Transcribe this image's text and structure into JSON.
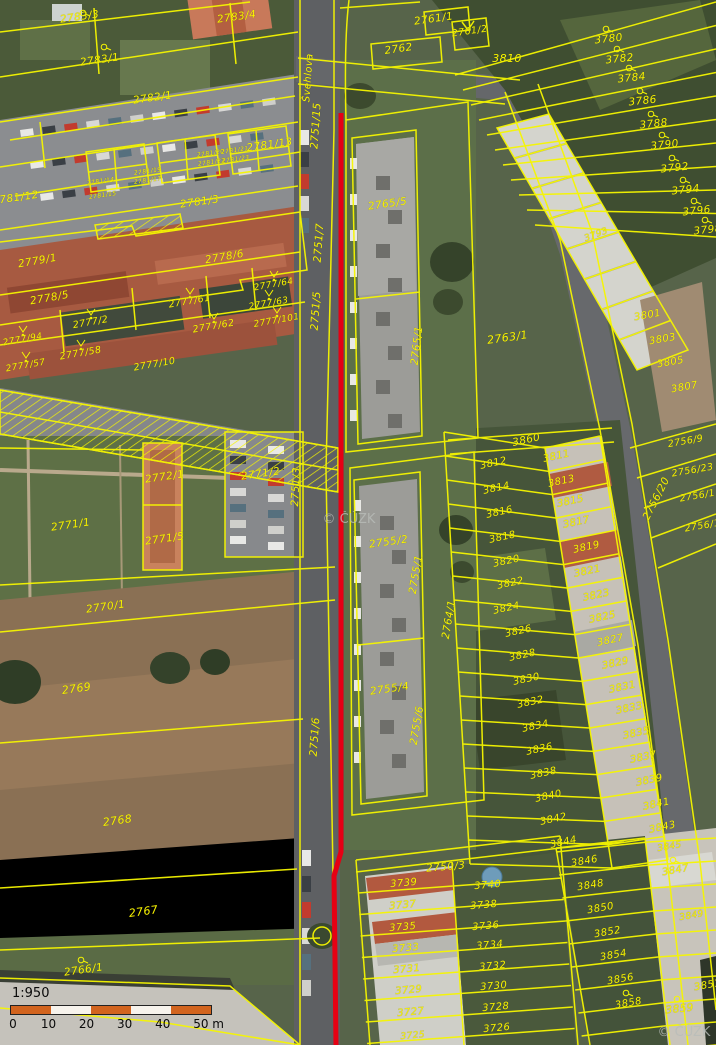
{
  "map": {
    "attribution": "© ČÚZK",
    "street_name": "Švehlova",
    "scale": {
      "ratio": "1:950",
      "ticks": [
        "0",
        "10",
        "20",
        "30",
        "40",
        "50 m"
      ]
    },
    "colors": {
      "parcel_line": "#f6f600",
      "parcel_label": "#f8f300",
      "highlight_line": "#e60014",
      "watermark": "#b9bdb9",
      "scalebar_orange": "#d2641e"
    },
    "red_line": {
      "points": [
        [
          341,
          113
        ],
        [
          341,
          852
        ],
        [
          334,
          876
        ],
        [
          336,
          1045
        ]
      ]
    },
    "watermarks": [
      {
        "t": "© ČÚZK",
        "x": 349,
        "y": 523
      },
      {
        "t": "© ČÚZK",
        "x": 684,
        "y": 1036
      }
    ],
    "labels": [
      {
        "t": "2783/3",
        "x": 80,
        "y": 20,
        "r": -8
      },
      {
        "t": "2783/4",
        "x": 237,
        "y": 20,
        "r": -8
      },
      {
        "t": "2783/1",
        "x": 100,
        "y": 63,
        "r": -8
      },
      {
        "t": "2782/1",
        "x": 153,
        "y": 101,
        "r": -8
      },
      {
        "t": "2781/13",
        "x": 270,
        "y": 148,
        "r": -8
      },
      {
        "t": "2781/12",
        "x": 16,
        "y": 201,
        "r": -8
      },
      {
        "t": "2781/3",
        "x": 200,
        "y": 205,
        "r": -8
      },
      {
        "t": "2781/20",
        "x": 211,
        "y": 155,
        "r": -8,
        "s": 6
      },
      {
        "t": "2781/21",
        "x": 235,
        "y": 152,
        "r": -8,
        "s": 6
      },
      {
        "t": "2781/22",
        "x": 212,
        "y": 164,
        "r": -8,
        "s": 6
      },
      {
        "t": "2781/23",
        "x": 236,
        "y": 161,
        "r": -8,
        "s": 6
      },
      {
        "t": "2781/19",
        "x": 148,
        "y": 173,
        "r": -8,
        "s": 6
      },
      {
        "t": "2781/17",
        "x": 148,
        "y": 182,
        "r": -8,
        "s": 6
      },
      {
        "t": "2781/14",
        "x": 101,
        "y": 183,
        "r": -8,
        "s": 6
      },
      {
        "t": "2781/15",
        "x": 103,
        "y": 197,
        "r": -8,
        "s": 6
      },
      {
        "t": "Švehlova",
        "x": 311,
        "y": 78,
        "r": -86,
        "s": 10
      },
      {
        "t": "2751/15",
        "x": 319,
        "y": 126,
        "r": -86
      },
      {
        "t": "2751/7",
        "x": 322,
        "y": 243,
        "r": -86
      },
      {
        "t": "2751/5",
        "x": 319,
        "y": 311,
        "r": -86
      },
      {
        "t": "2751/3",
        "x": 299,
        "y": 487,
        "r": -87
      },
      {
        "t": "2751/6",
        "x": 318,
        "y": 737,
        "r": -86
      },
      {
        "t": "2761/1",
        "x": 434,
        "y": 22,
        "r": -8
      },
      {
        "t": "2761/2",
        "x": 470,
        "y": 34,
        "r": -8,
        "s": 9.5
      },
      {
        "t": "2762",
        "x": 399,
        "y": 52,
        "r": -8
      },
      {
        "t": "3810",
        "x": 507,
        "y": 62,
        "r": 0,
        "s": 11
      },
      {
        "t": "2765/5",
        "x": 388,
        "y": 207,
        "r": -8
      },
      {
        "t": "2765/1",
        "x": 420,
        "y": 346,
        "r": -83
      },
      {
        "t": "2763/1",
        "x": 508,
        "y": 341,
        "r": -8,
        "s": 11
      },
      {
        "t": "2755/2",
        "x": 389,
        "y": 545,
        "r": -8
      },
      {
        "t": "2755/1",
        "x": 419,
        "y": 575,
        "r": -80
      },
      {
        "t": "2755/4",
        "x": 390,
        "y": 692,
        "r": -8
      },
      {
        "t": "2755/6",
        "x": 420,
        "y": 726,
        "r": -80
      },
      {
        "t": "2764/1",
        "x": 452,
        "y": 620,
        "r": -80
      },
      {
        "t": "2779/1",
        "x": 38,
        "y": 264,
        "r": -10
      },
      {
        "t": "2778/5",
        "x": 50,
        "y": 301,
        "r": -10
      },
      {
        "t": "2778/6",
        "x": 225,
        "y": 260,
        "r": -10
      },
      {
        "t": "2777/64",
        "x": 274,
        "y": 287,
        "r": -10,
        "s": 9,
        "v": 1
      },
      {
        "t": "2777/61",
        "x": 190,
        "y": 304,
        "r": -10,
        "s": 9.5,
        "v": 1
      },
      {
        "t": "2777/63",
        "x": 269,
        "y": 306,
        "r": -10,
        "s": 9,
        "v": 1
      },
      {
        "t": "2777/101",
        "x": 277,
        "y": 323,
        "r": -10,
        "s": 9,
        "v": 1
      },
      {
        "t": "2777/2",
        "x": 91,
        "y": 325,
        "r": -10,
        "s": 9.5,
        "v": 1
      },
      {
        "t": "2777/62",
        "x": 214,
        "y": 329,
        "r": -10,
        "s": 9.5,
        "v": 1
      },
      {
        "t": "2777/94",
        "x": 23,
        "y": 342,
        "r": -10,
        "s": 9,
        "v": 1
      },
      {
        "t": "2777/58",
        "x": 81,
        "y": 356,
        "r": -10,
        "s": 9.5,
        "v": 1
      },
      {
        "t": "2777/57",
        "x": 26,
        "y": 368,
        "r": -10,
        "s": 9,
        "v": 1
      },
      {
        "t": "2777/10",
        "x": 155,
        "y": 367,
        "r": -10,
        "s": 9.5
      },
      {
        "t": "2772/1",
        "x": 165,
        "y": 480,
        "r": -8
      },
      {
        "t": "2771/2",
        "x": 261,
        "y": 477,
        "r": -8
      },
      {
        "t": "2771/1",
        "x": 71,
        "y": 528,
        "r": -8
      },
      {
        "t": "2771/5",
        "x": 165,
        "y": 542,
        "r": -8
      },
      {
        "t": "2770/1",
        "x": 106,
        "y": 610,
        "r": -8
      },
      {
        "t": "2769",
        "x": 77,
        "y": 692,
        "r": -8,
        "s": 11
      },
      {
        "t": "2768",
        "x": 118,
        "y": 824,
        "r": -8,
        "s": 11
      },
      {
        "t": "2767",
        "x": 144,
        "y": 915,
        "r": -8,
        "s": 11
      },
      {
        "t": "2766/1",
        "x": 84,
        "y": 973,
        "r": -8,
        "sym": 1
      },
      {
        "t": "3780",
        "x": 609,
        "y": 42,
        "r": -6,
        "sym": 1
      },
      {
        "t": "3782",
        "x": 620,
        "y": 62,
        "r": -6,
        "sym": 1
      },
      {
        "t": "3784",
        "x": 632,
        "y": 81,
        "r": -6,
        "sym": 1
      },
      {
        "t": "3786",
        "x": 643,
        "y": 104,
        "r": -6,
        "sym": 1
      },
      {
        "t": "3788",
        "x": 654,
        "y": 127,
        "r": -6,
        "sym": 1
      },
      {
        "t": "3790",
        "x": 665,
        "y": 148,
        "r": -6,
        "sym": 1
      },
      {
        "t": "3792",
        "x": 675,
        "y": 171,
        "r": -6,
        "sym": 1
      },
      {
        "t": "3794",
        "x": 686,
        "y": 193,
        "r": -6,
        "sym": 1
      },
      {
        "t": "3796",
        "x": 697,
        "y": 214,
        "r": -6,
        "sym": 1
      },
      {
        "t": "3798",
        "x": 708,
        "y": 233,
        "r": -6,
        "sym": 1
      },
      {
        "t": "3793",
        "x": 597,
        "y": 237,
        "r": -20,
        "s": 9
      },
      {
        "t": "3801",
        "x": 648,
        "y": 318,
        "r": -10,
        "s": 10
      },
      {
        "t": "3803",
        "x": 663,
        "y": 342,
        "r": -10,
        "s": 10
      },
      {
        "t": "3805",
        "x": 671,
        "y": 365,
        "r": -10,
        "s": 10
      },
      {
        "t": "3807",
        "x": 685,
        "y": 390,
        "r": -10,
        "s": 10
      },
      {
        "t": "3860",
        "x": 527,
        "y": 443,
        "r": -12
      },
      {
        "t": "3812",
        "x": 494,
        "y": 466,
        "r": -12,
        "s": 10
      },
      {
        "t": "3814",
        "x": 497,
        "y": 491,
        "r": -12,
        "s": 10
      },
      {
        "t": "3816",
        "x": 500,
        "y": 515,
        "r": -12,
        "s": 10
      },
      {
        "t": "3818",
        "x": 503,
        "y": 540,
        "r": -12,
        "s": 10
      },
      {
        "t": "3820",
        "x": 507,
        "y": 564,
        "r": -12,
        "s": 10
      },
      {
        "t": "3822",
        "x": 511,
        "y": 586,
        "r": -12,
        "s": 10
      },
      {
        "t": "3824",
        "x": 507,
        "y": 611,
        "r": -12,
        "s": 10
      },
      {
        "t": "3826",
        "x": 519,
        "y": 634,
        "r": -12,
        "s": 10
      },
      {
        "t": "3828",
        "x": 523,
        "y": 658,
        "r": -12,
        "s": 10
      },
      {
        "t": "3830",
        "x": 527,
        "y": 682,
        "r": -12,
        "s": 10
      },
      {
        "t": "3832",
        "x": 531,
        "y": 705,
        "r": -12,
        "s": 10
      },
      {
        "t": "3834",
        "x": 536,
        "y": 729,
        "r": -12,
        "s": 10
      },
      {
        "t": "3836",
        "x": 540,
        "y": 752,
        "r": -12,
        "s": 10
      },
      {
        "t": "3838",
        "x": 544,
        "y": 776,
        "r": -12,
        "s": 10
      },
      {
        "t": "3840",
        "x": 549,
        "y": 799,
        "r": -12,
        "s": 10
      },
      {
        "t": "3842",
        "x": 554,
        "y": 822,
        "r": -12,
        "s": 10
      },
      {
        "t": "3844",
        "x": 564,
        "y": 845,
        "r": -12,
        "s": 10
      },
      {
        "t": "3811",
        "x": 557,
        "y": 459,
        "r": -12,
        "s": 10
      },
      {
        "t": "3813",
        "x": 562,
        "y": 484,
        "r": -12,
        "s": 10
      },
      {
        "t": "3815",
        "x": 571,
        "y": 504,
        "r": -12,
        "s": 10
      },
      {
        "t": "3817",
        "x": 577,
        "y": 525,
        "r": -12,
        "s": 10
      },
      {
        "t": "3819",
        "x": 587,
        "y": 550,
        "r": -12,
        "s": 10
      },
      {
        "t": "3821",
        "x": 588,
        "y": 574,
        "r": -12,
        "s": 10
      },
      {
        "t": "3823",
        "x": 597,
        "y": 598,
        "r": -12,
        "s": 10
      },
      {
        "t": "3825",
        "x": 603,
        "y": 620,
        "r": -12,
        "s": 10
      },
      {
        "t": "3827",
        "x": 611,
        "y": 643,
        "r": -12,
        "s": 10
      },
      {
        "t": "3829",
        "x": 616,
        "y": 666,
        "r": -12,
        "s": 10
      },
      {
        "t": "3831",
        "x": 623,
        "y": 690,
        "r": -12,
        "s": 10
      },
      {
        "t": "3833",
        "x": 630,
        "y": 711,
        "r": -12,
        "s": 10
      },
      {
        "t": "3835",
        "x": 637,
        "y": 736,
        "r": -12,
        "s": 10
      },
      {
        "t": "3837",
        "x": 644,
        "y": 760,
        "r": -12,
        "s": 10
      },
      {
        "t": "3839",
        "x": 650,
        "y": 783,
        "r": -12,
        "s": 10
      },
      {
        "t": "3841",
        "x": 657,
        "y": 807,
        "r": -12,
        "s": 10
      },
      {
        "t": "3843",
        "x": 663,
        "y": 830,
        "r": -12,
        "s": 10
      },
      {
        "t": "3846",
        "x": 585,
        "y": 864,
        "r": -10,
        "s": 10
      },
      {
        "t": "3848",
        "x": 591,
        "y": 888,
        "r": -10,
        "s": 10
      },
      {
        "t": "3850",
        "x": 601,
        "y": 911,
        "r": -10,
        "s": 10
      },
      {
        "t": "3852",
        "x": 608,
        "y": 935,
        "r": -10,
        "s": 10
      },
      {
        "t": "3854",
        "x": 614,
        "y": 958,
        "r": -10,
        "s": 10
      },
      {
        "t": "3856",
        "x": 621,
        "y": 982,
        "r": -10,
        "s": 10
      },
      {
        "t": "3858",
        "x": 629,
        "y": 1006,
        "r": -10,
        "s": 10,
        "sym": 1
      },
      {
        "t": "3845",
        "x": 670,
        "y": 849,
        "r": -10,
        "s": 9
      },
      {
        "t": "3847",
        "x": 676,
        "y": 873,
        "r": -10,
        "s": 10,
        "sym": 1
      },
      {
        "t": "3849",
        "x": 692,
        "y": 918,
        "r": -10,
        "s": 9
      },
      {
        "t": "3851",
        "x": 708,
        "y": 988,
        "r": -10,
        "s": 10
      },
      {
        "t": "3859",
        "x": 680,
        "y": 1012,
        "r": -6,
        "s": 10.5,
        "sym": 1
      },
      {
        "t": "2756/20",
        "x": 659,
        "y": 500,
        "r": -63
      },
      {
        "t": "2756/9",
        "x": 686,
        "y": 444,
        "r": -10,
        "s": 9.5
      },
      {
        "t": "2756/23",
        "x": 693,
        "y": 473,
        "r": -10,
        "s": 9.5
      },
      {
        "t": "2756/11",
        "x": 701,
        "y": 498,
        "r": -10,
        "s": 9.5
      },
      {
        "t": "2756/13",
        "x": 706,
        "y": 528,
        "r": -10,
        "s": 9.5
      },
      {
        "t": "2750/3",
        "x": 446,
        "y": 870,
        "r": -5
      },
      {
        "t": "3739",
        "x": 404,
        "y": 886,
        "r": -5,
        "s": 10
      },
      {
        "t": "3740",
        "x": 488,
        "y": 888,
        "r": -5,
        "s": 10
      },
      {
        "t": "3737",
        "x": 403,
        "y": 908,
        "r": -5,
        "s": 10
      },
      {
        "t": "3738",
        "x": 484,
        "y": 908,
        "r": -5,
        "s": 10
      },
      {
        "t": "3735",
        "x": 403,
        "y": 930,
        "r": -5,
        "s": 10
      },
      {
        "t": "3736",
        "x": 486,
        "y": 929,
        "r": -5,
        "s": 10
      },
      {
        "t": "3733",
        "x": 406,
        "y": 951,
        "r": -5,
        "s": 10
      },
      {
        "t": "3734",
        "x": 490,
        "y": 948,
        "r": -5,
        "s": 10
      },
      {
        "t": "3731",
        "x": 407,
        "y": 972,
        "r": -5,
        "s": 10
      },
      {
        "t": "3732",
        "x": 493,
        "y": 969,
        "r": -5,
        "s": 10
      },
      {
        "t": "3729",
        "x": 409,
        "y": 993,
        "r": -5,
        "s": 10
      },
      {
        "t": "3730",
        "x": 494,
        "y": 989,
        "r": -5,
        "s": 10
      },
      {
        "t": "3727",
        "x": 411,
        "y": 1015,
        "r": -5,
        "s": 10
      },
      {
        "t": "3728",
        "x": 496,
        "y": 1010,
        "r": -5,
        "s": 10
      },
      {
        "t": "3725",
        "x": 413,
        "y": 1038,
        "r": -5,
        "s": 9
      },
      {
        "t": "3726",
        "x": 497,
        "y": 1031,
        "r": -5,
        "s": 10
      }
    ],
    "standalone_symbols": [
      {
        "x": 83,
        "y": 13
      },
      {
        "x": 104,
        "y": 47
      }
    ]
  }
}
